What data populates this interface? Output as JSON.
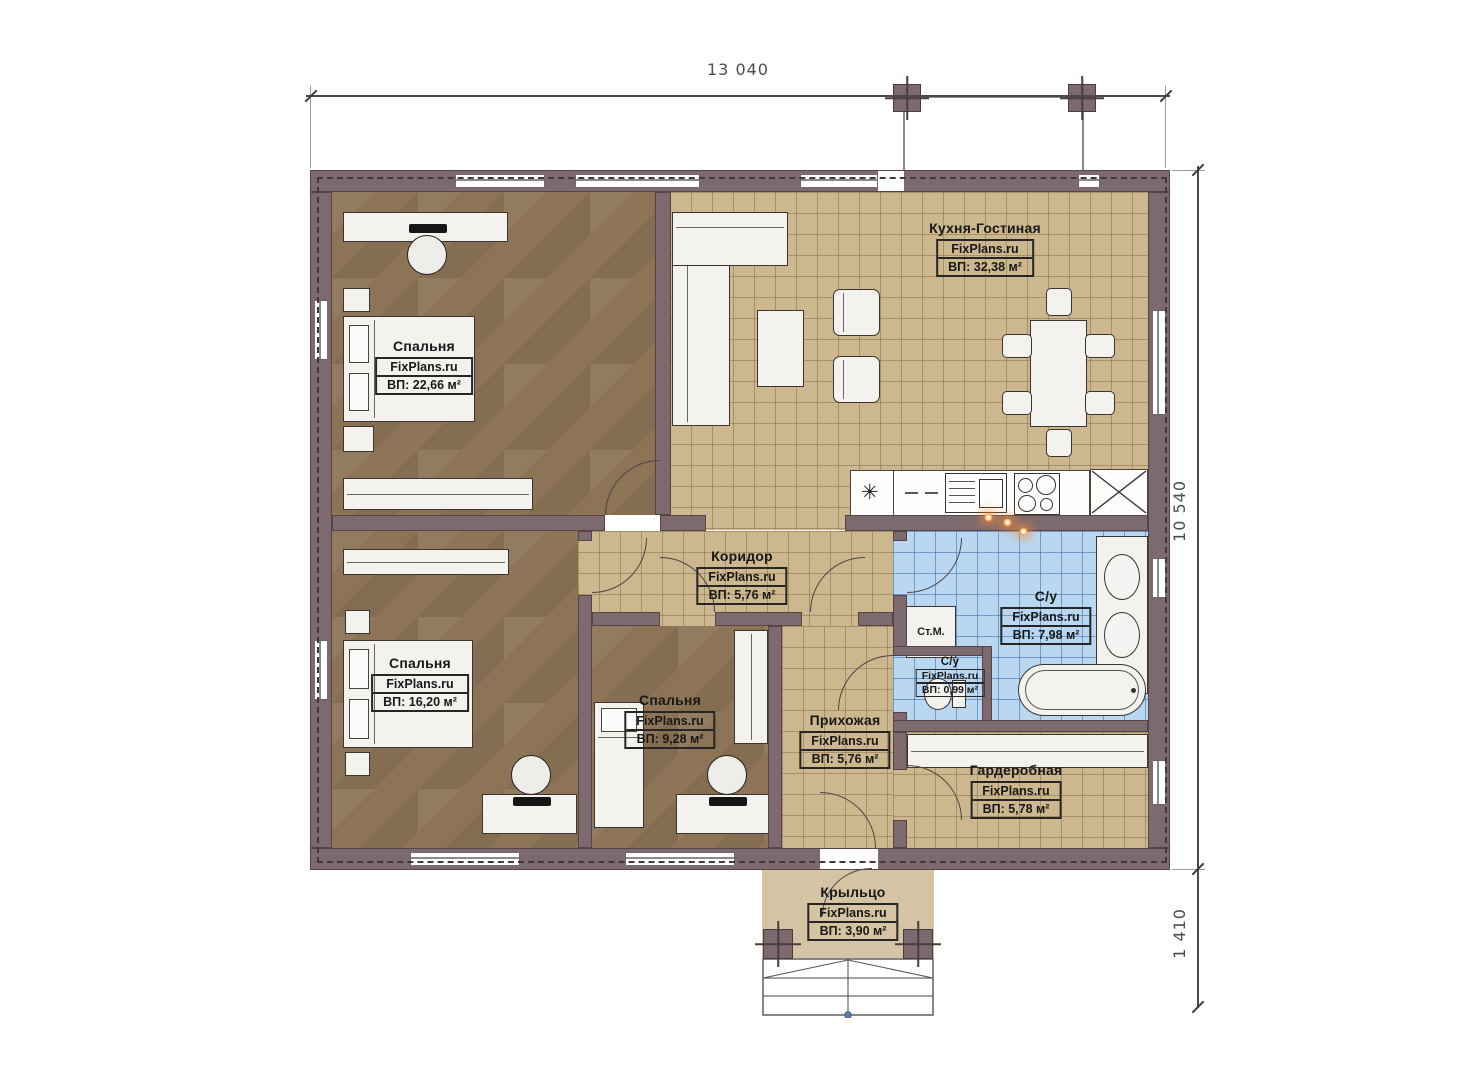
{
  "plan": {
    "watermark": "FixPlans.ru",
    "dimensions": {
      "width_top": "13 040",
      "height_right": "10 540",
      "porch_right": "1 410"
    },
    "rooms": [
      {
        "id": "kitchen_living",
        "name": "Кухня-Гостиная",
        "brand": "FixPlans.ru",
        "area": "ВП: 32,38 м²"
      },
      {
        "id": "bedroom_top_left",
        "name": "Спальня",
        "brand": "FixPlans.ru",
        "area": "ВП: 22,66 м²"
      },
      {
        "id": "bedroom_bottom_left",
        "name": "Спальня",
        "brand": "FixPlans.ru",
        "area": "ВП: 16,20 м²"
      },
      {
        "id": "bedroom_middle",
        "name": "Спальня",
        "brand": "FixPlans.ru",
        "area": "ВП: 9,28 м²"
      },
      {
        "id": "corridor",
        "name": "Коридор",
        "brand": "FixPlans.ru",
        "area": "ВП: 5,76 м²"
      },
      {
        "id": "bathroom",
        "name": "С/у",
        "brand": "FixPlans.ru",
        "area": "ВП: 7,98 м²"
      },
      {
        "id": "wc",
        "name": "С/у",
        "brand": "FixPlans.ru",
        "area": "ВП: 0,99 м²"
      },
      {
        "id": "hallway",
        "name": "Прихожая",
        "brand": "FixPlans.ru",
        "area": "ВП: 5,76 м²"
      },
      {
        "id": "wardrobe",
        "name": "Гардеробная",
        "brand": "FixPlans.ru",
        "area": "ВП: 5,78 м²"
      },
      {
        "id": "porch",
        "name": "Крыльцо",
        "brand": "FixPlans.ru",
        "area": "ВП: 3,90 м²"
      }
    ],
    "appliances": {
      "washing_machine": "Ст.М."
    },
    "icons": {
      "fridge_symbol": "✳"
    },
    "colors": {
      "wall": "#7d6a6e",
      "wood_floor": "#8d7456",
      "tile_tan": "#ccb78e",
      "tile_blue": "#b9d7f1",
      "porch": "#d5c4a4",
      "sconce_orange": "#ff9a3d"
    }
  }
}
